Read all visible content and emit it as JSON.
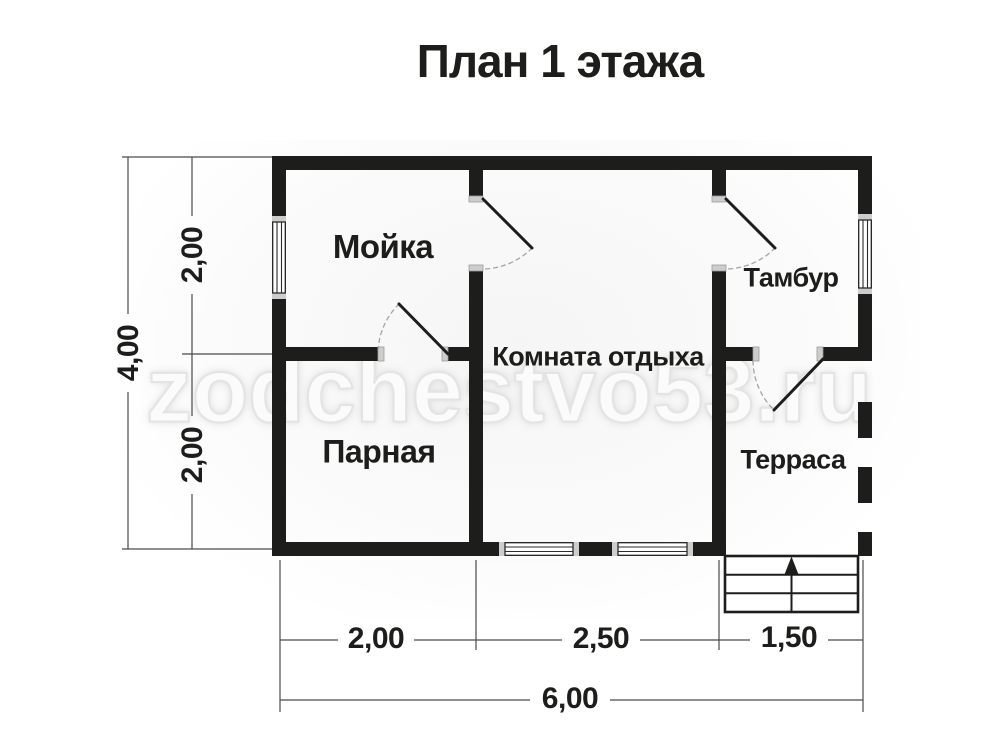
{
  "title": "План 1 этажа",
  "watermark": "zodchestvo53.ru",
  "rooms": {
    "washroom": {
      "label": "Мойка"
    },
    "steam_room": {
      "label": "Парная"
    },
    "lounge": {
      "label": "Комната отдыха"
    },
    "vestibule": {
      "label": "Тамбур"
    },
    "terrace": {
      "label": "Терраса"
    }
  },
  "dimensions": {
    "left_total": "4,00",
    "left_top": "2,00",
    "left_bottom": "2,00",
    "bottom_segments": [
      "2,00",
      "2,50",
      "1,50"
    ],
    "bottom_total": "6,00"
  },
  "stairs": {
    "steps": 3,
    "direction_icon": "up-arrow"
  },
  "colors": {
    "wall": "#1d1d1b",
    "dimension_line": "#4a4a4a",
    "watermark": "#e9e9e9",
    "background": "#ffffff"
  }
}
